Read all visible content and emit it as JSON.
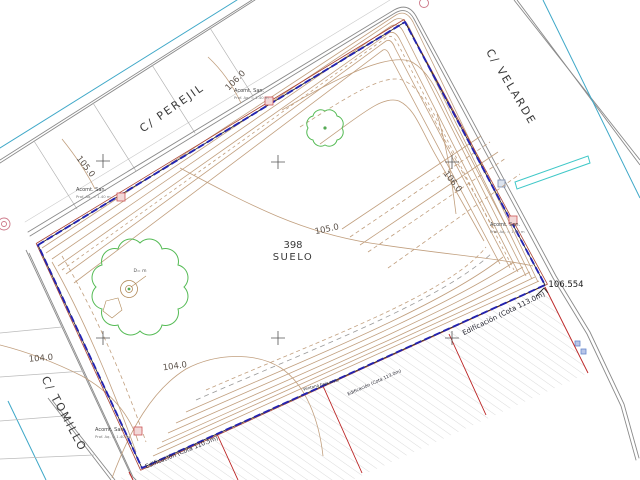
{
  "drawing": {
    "streets": [
      {
        "name": "C/ PEREJIL"
      },
      {
        "name": "C/ VELARDE"
      },
      {
        "name": "C/ TOMILLO"
      }
    ],
    "parcel": {
      "number": "398",
      "type_label": "SUELO"
    },
    "spot_elevation": "106.554",
    "contour_labels": [
      {
        "text": "106.0"
      },
      {
        "text": "105.0"
      },
      {
        "text": "106.0"
      },
      {
        "text": "105.0"
      },
      {
        "text": "104.0"
      },
      {
        "text": "104.0"
      }
    ],
    "building_lines": [
      {
        "text": "Edificación  (Cota 110.5m)"
      },
      {
        "text": "Edificación  (Cota 113.0m)"
      },
      {
        "text": "Edificación  (Cota 113.0m)"
      }
    ],
    "small_note": "Ventana baja nivel",
    "tree_label": "D= m",
    "service_connections": [
      {
        "title": "Acomt. San.",
        "detail": "Prof. Aq. = 1.40 m"
      },
      {
        "title": "Acomt. San.",
        "detail": "Prof. Aq. = 1.40 m"
      },
      {
        "title": "Acomt. San.",
        "detail": "Prof. Aq. = 1.40 m"
      },
      {
        "title": "Acomt. San.",
        "detail": "Prof. Aq. = 1.40 m"
      }
    ],
    "colors": {
      "boundary_blue": "#2323b0",
      "boundary_red": "#aa4433",
      "contour_tan": "#c19f7e",
      "water_cyan": "#3fa8c8",
      "hatch_gray": "#cccccc",
      "setback_red": "#bb2222",
      "tree_green": "#55bb55",
      "street_gray": "#909090"
    }
  }
}
